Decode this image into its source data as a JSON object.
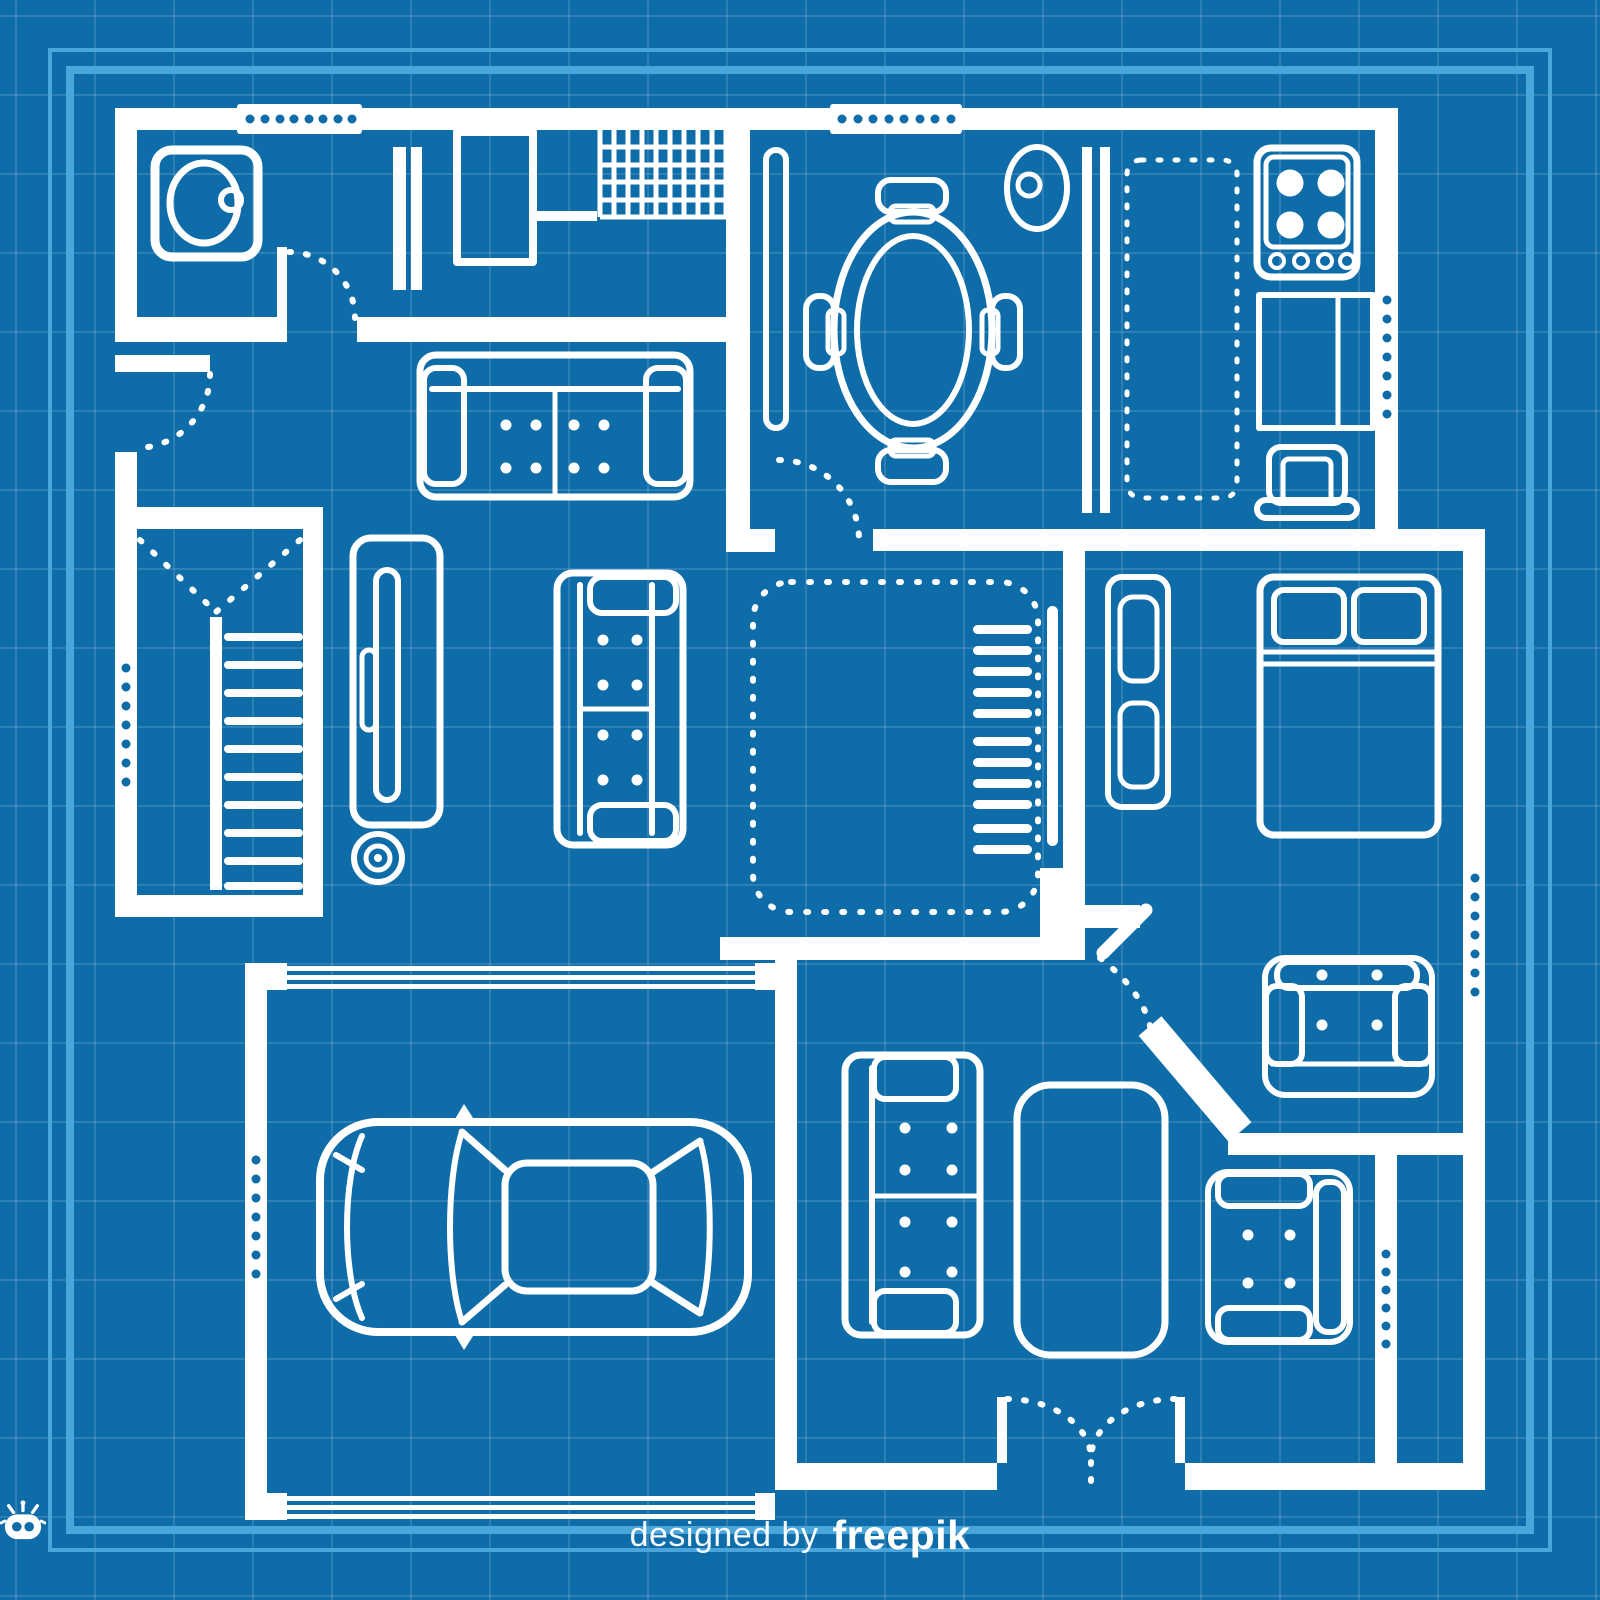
{
  "scene": {
    "kind": "architectural-blueprint-floor-plan",
    "view": "top-down",
    "style": "white outline drawing over blue grid paper with double light-blue frame"
  },
  "palette": {
    "background": "#0e6ca9",
    "drawing": "#ffffff",
    "frame": "#4aa5db",
    "grid_line": "rgba(255,255,255,0.13)"
  },
  "footer": {
    "credit_prefix": "designed by",
    "brand": "freepik",
    "icon": "freepik-robot-icon"
  },
  "rooms": [
    {
      "id": "bathroom-laundry",
      "furniture": [
        "washing-machine",
        "radiator",
        "vanity-cabinet",
        "tiled-shower"
      ]
    },
    {
      "id": "dining-room",
      "furniture": [
        "oval-dining-table",
        "dining-chair x4",
        "console-shelf",
        "side-basin"
      ]
    },
    {
      "id": "kitchen",
      "furniture": [
        "counter-divider",
        "overhead-cabinets-dashed",
        "stove-4-burners",
        "counter-with-sink",
        "kitchen-chair"
      ]
    },
    {
      "id": "living-room",
      "furniture": [
        "sofa-horizontal",
        "sofa-vertical",
        "tv-cabinet",
        "speaker"
      ]
    },
    {
      "id": "closet-room",
      "furniture": [
        "dashed-wardrobe-marker",
        "staircase-down"
      ]
    },
    {
      "id": "hallway",
      "furniture": [
        "stairwell-dashed-void",
        "staircase-up",
        "handrail"
      ]
    },
    {
      "id": "bedroom",
      "furniture": [
        "wardrobe",
        "double-bed-two-pillows"
      ]
    },
    {
      "id": "reading-nook",
      "furniture": [
        "armchair-facing-down"
      ]
    },
    {
      "id": "lounge",
      "furniture": [
        "sofa-facing-right",
        "coffee-table",
        "armchair-facing-left"
      ]
    },
    {
      "id": "garage",
      "furniture": [
        "car-top-view",
        "garage-door-top",
        "garage-door-bottom"
      ]
    },
    {
      "id": "storage-room",
      "furniture": []
    }
  ],
  "openings": {
    "window_strips": 7,
    "single_doors": 4,
    "double-entry-door": 1
  }
}
